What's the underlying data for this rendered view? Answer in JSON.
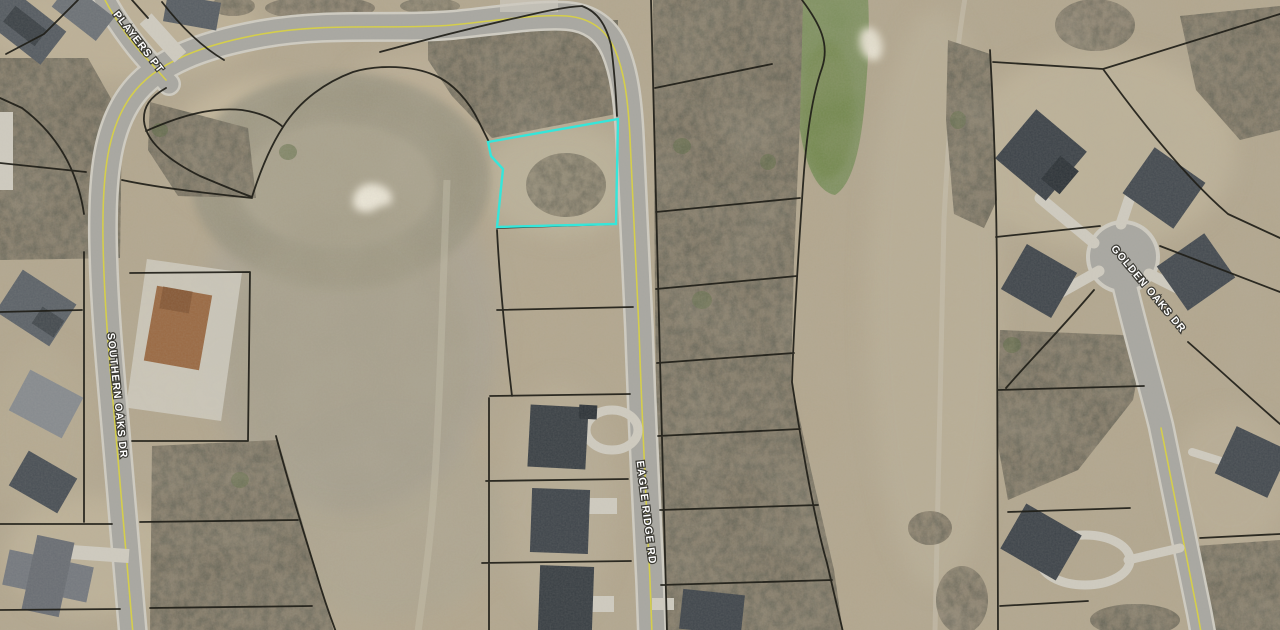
{
  "map": {
    "description": "Aerial parcel map of golf-course community with one lot highlighted",
    "streets": {
      "players_pt": "PLAYERS PT",
      "southern_oaks": "SOUTHERN OAKS DR",
      "eagle_ridge": "EAGLE RIDGE RD",
      "golden_oaks": "GOLDEN OAKS DR"
    },
    "highlighted_parcel": {
      "outline_color": "#35e6da"
    },
    "colors": {
      "terrain": "#b3a78f",
      "water": "#7f9160",
      "road": "#a8a7a1",
      "road_casing": "#cfccc2",
      "centerline_yellow": "#d9d23f",
      "parcel_line": "#1f1e18",
      "label_fill": "#ffffff",
      "label_halo": "#3c3b35",
      "sand_bunker": "#ece7d8"
    }
  }
}
